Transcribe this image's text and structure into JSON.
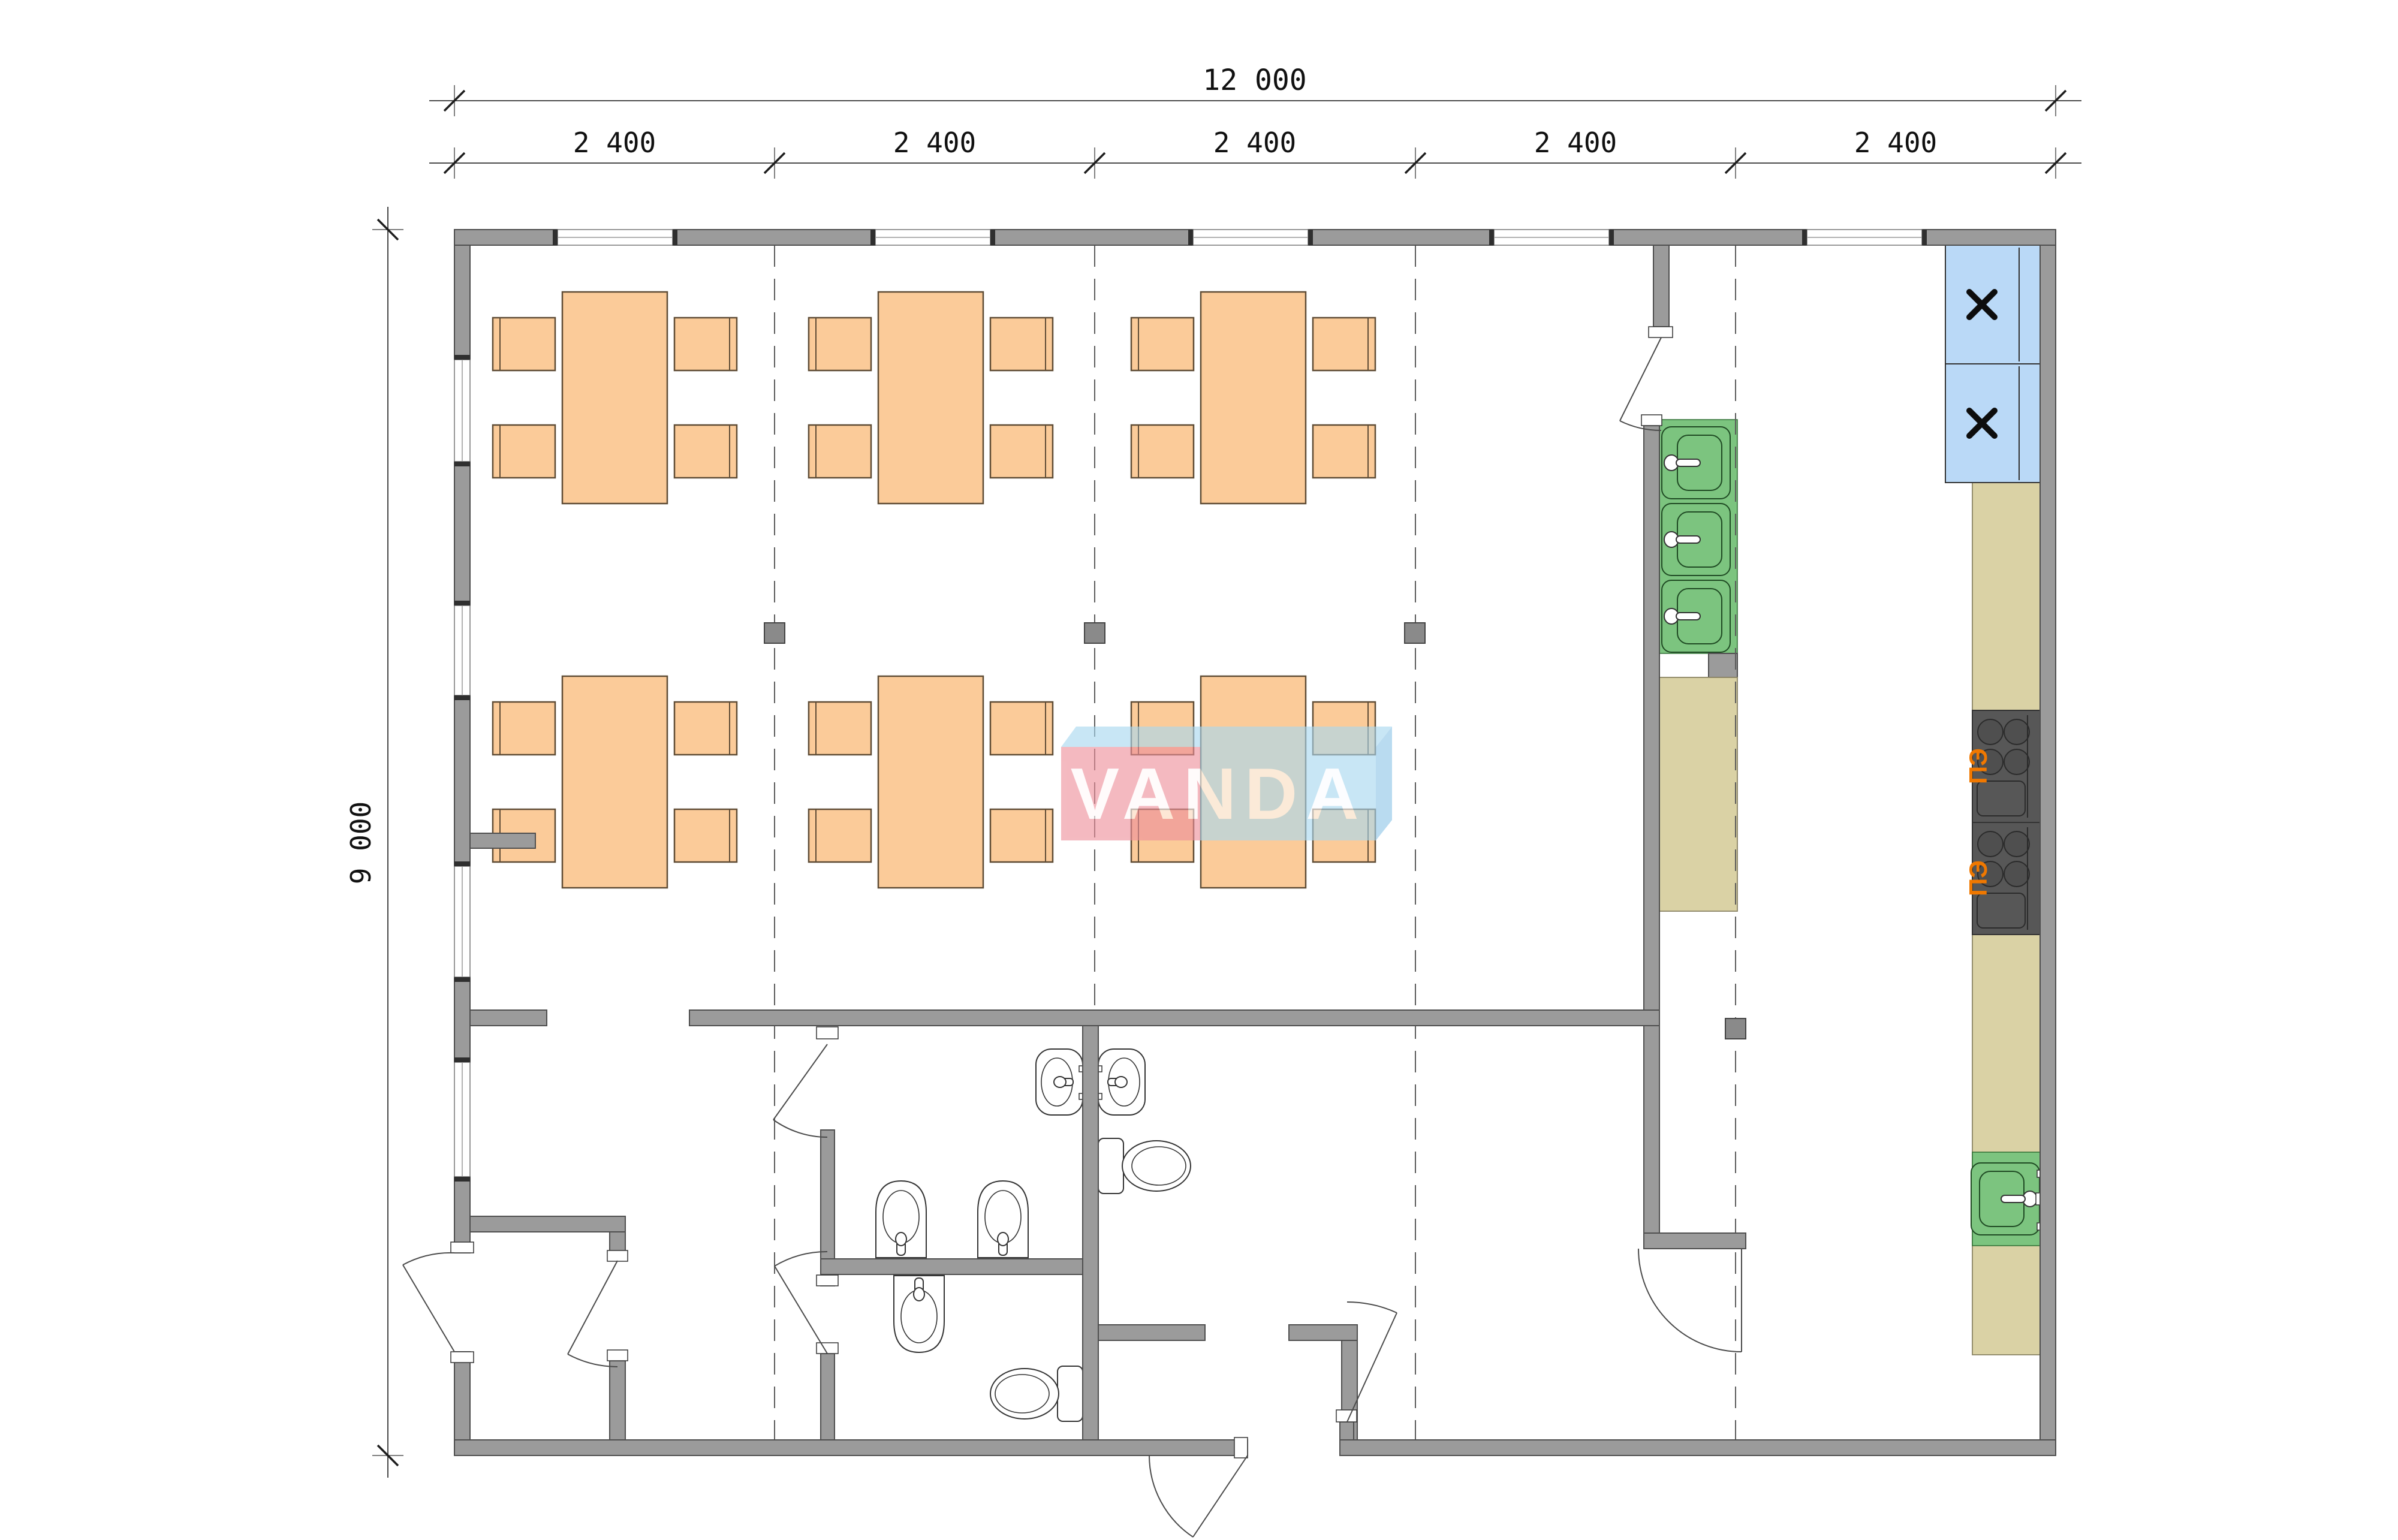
{
  "drawing": {
    "type": "architectural-floor-plan",
    "watermark_text": "VANDA",
    "dimensions": {
      "total_width_label": "12 000",
      "module_labels": [
        "2 400",
        "2 400",
        "2 400",
        "2 400",
        "2 400"
      ],
      "height_label": "9 000"
    },
    "equipment_labels": {
      "stoves": [
        "ПЭ",
        "ПЭ"
      ],
      "fridge_marks": [
        "x",
        "x"
      ]
    },
    "furniture": {
      "dining_tables": 6,
      "chairs_per_table": 4,
      "kitchen_sinks": 4,
      "wash_basins": 5,
      "toilets": 2,
      "refrigerators": 2,
      "electric_stoves": 2
    },
    "colors": {
      "wall_gray": "#9B9B9B",
      "furniture_peach": "#FBCB99",
      "sink_green": "#7CC47F",
      "counter_beige": "#DAD2A5",
      "fridge_blue": "#BAD9F7",
      "stove_dark": "#575757",
      "stove_label_orange": "#F07800",
      "watermark_pink": "#EE8F9B",
      "watermark_blue": "#A8D8F0"
    }
  }
}
